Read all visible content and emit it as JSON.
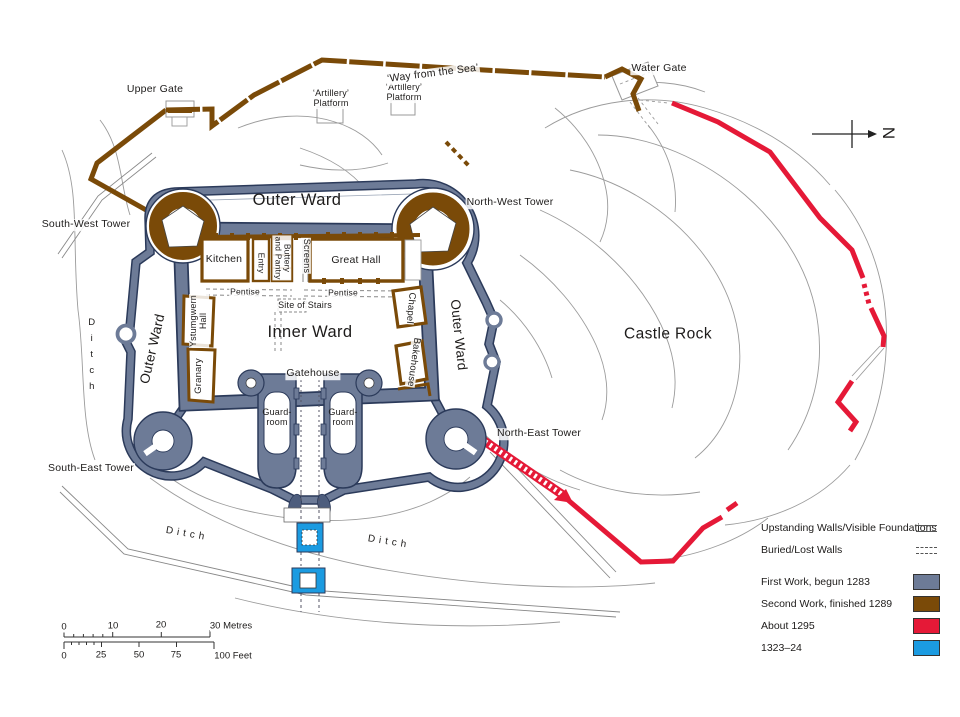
{
  "colors": {
    "first_work": "#6d7b97",
    "second_work": "#7a4a08",
    "about_1295": "#e51937",
    "work_1323_24": "#1b9be1",
    "wall_outline": "#2b3a5a",
    "contour_grey": "#9b9b9b"
  },
  "map_labels": {
    "upper_gate": "Upper Gate",
    "artillery_platform_a": {
      "l1": "‘Artillery’",
      "l2": "Platform"
    },
    "artillery_platform_b": {
      "l1": "‘Artillery’",
      "l2": "Platform"
    },
    "way_from_the_sea": "‘Way from the Sea’",
    "water_gate": "Water Gate",
    "south_west_tower": "South-West Tower",
    "north_west_tower": "North-West Tower",
    "north_east_tower": "North-East Tower",
    "south_east_tower": "South-East Tower",
    "outer_ward_top": "Outer Ward",
    "outer_ward_left": "Outer Ward",
    "outer_ward_right": "Outer Ward",
    "inner_ward": "Inner Ward",
    "castle_rock": "Castle Rock",
    "kitchen": "Kitchen",
    "entry": "Entry",
    "buttery_pantry": {
      "l1": "Buttery",
      "l2": "and Pantry"
    },
    "screens": "Screens",
    "great_hall": "Great Hall",
    "pentise_a": "Pentise",
    "pentise_b": "Pentise",
    "site_of_stairs": "Site of Stairs",
    "ystumgwern_hall": {
      "l1": "Ystumgwern",
      "l2": "Hall"
    },
    "granary": "Granary",
    "chapel": "Chapel",
    "bakehouse": "Bakehouse",
    "gatehouse": "Gatehouse",
    "guard_room_left": {
      "l1": "Guard-",
      "l2": "room"
    },
    "guard_room_right": {
      "l1": "Guard-",
      "l2": "room"
    },
    "ditch_west": "Ditch",
    "ditch_south": "Ditch",
    "ditch_east": "Ditch"
  },
  "compass": {
    "north_label": "N"
  },
  "scale_bar": {
    "metres": [
      "0",
      "10",
      "20",
      "30 Metres"
    ],
    "feet": [
      "0",
      "25",
      "50",
      "75",
      "100 Feet"
    ]
  },
  "legend": {
    "upstanding_walls": "Upstanding Walls/Visible Foundations",
    "buried_walls": "Buried/Lost Walls",
    "first_work": "First Work, begun 1283",
    "second_work": "Second Work, finished 1289",
    "about_1295": "About 1295",
    "work_1323_24": "1323–24"
  }
}
